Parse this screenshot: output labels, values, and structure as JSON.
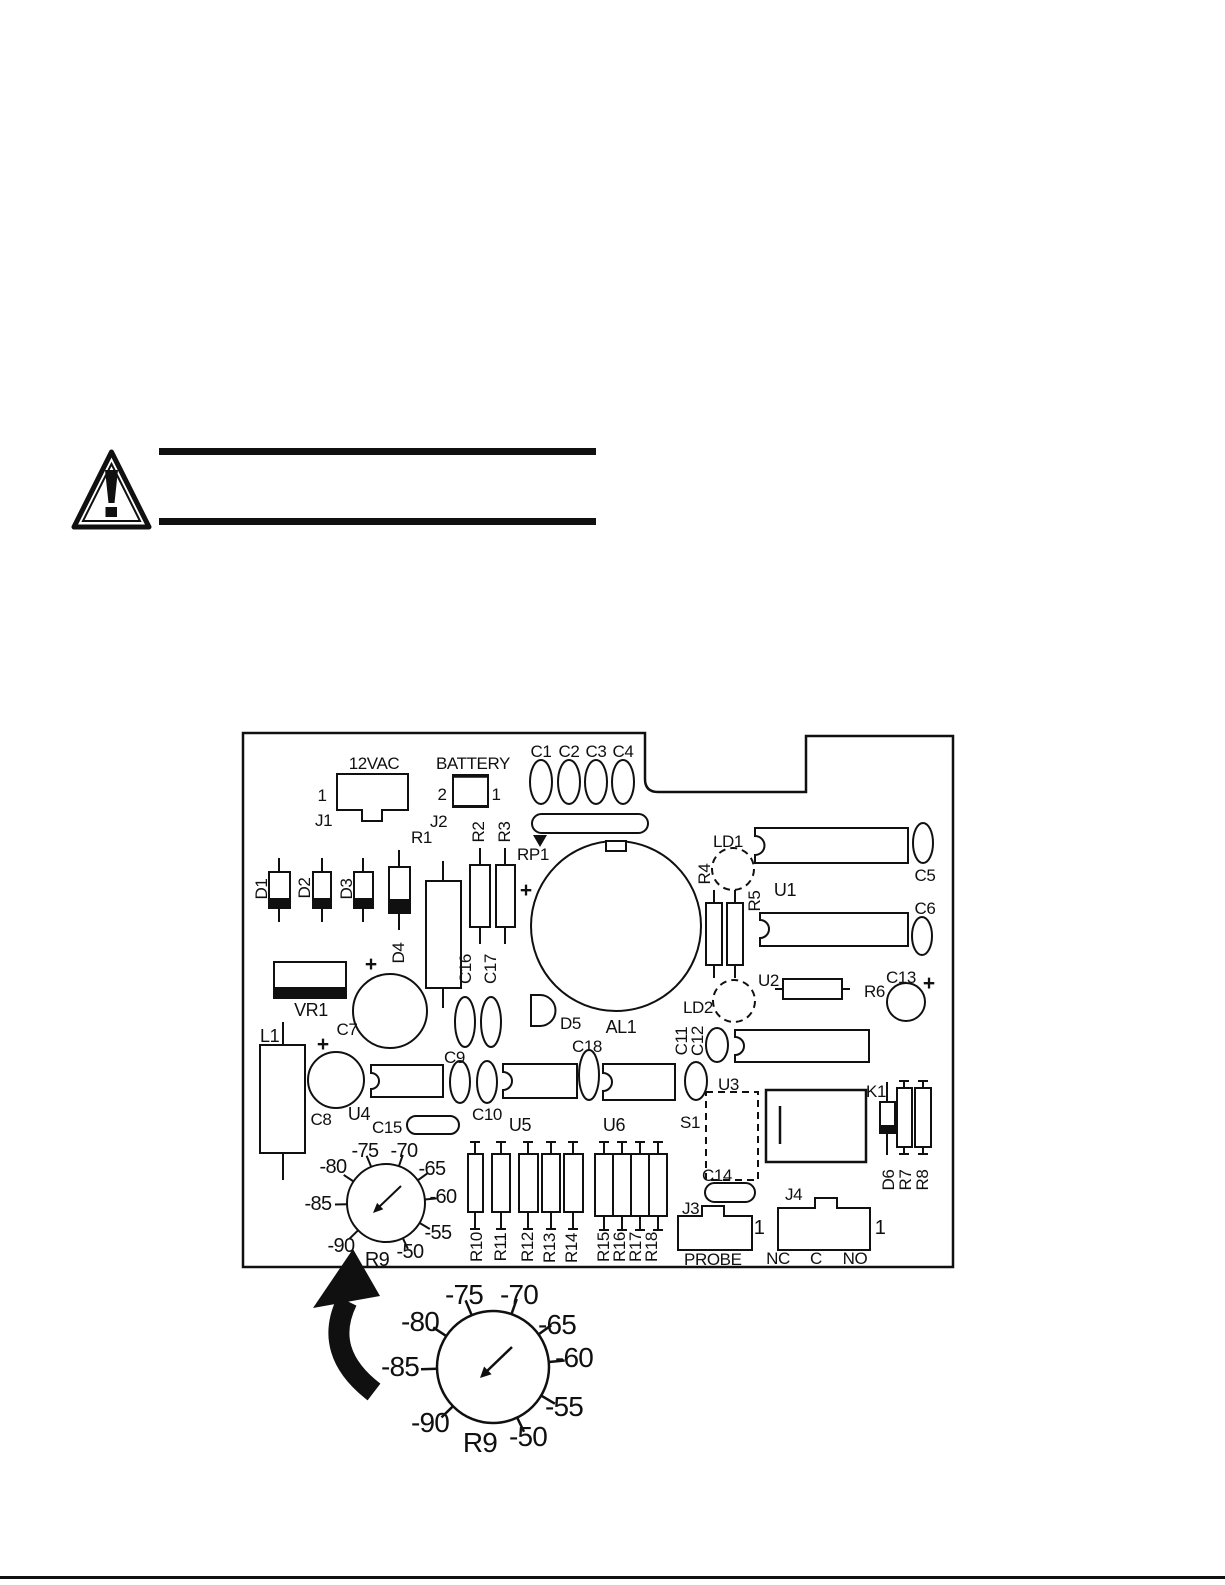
{
  "pcb": {
    "labels": {
      "plus": "+",
      "j1_title": "12VAC",
      "j1_name": "J1",
      "j1_pin1": "1",
      "j2_title": "BATTERY",
      "j2_name": "J2",
      "j2_pin1": "1",
      "j2_pin2": "2",
      "c1": "C1",
      "c2": "C2",
      "c3": "C3",
      "c4": "C4",
      "rp1": "RP1",
      "r1": "R1",
      "r2": "R2",
      "r3": "R3",
      "d1": "D1",
      "d2": "D2",
      "d3": "D3",
      "d4": "D4",
      "d5": "D5",
      "ld1": "LD1",
      "ld2": "LD2",
      "r4": "R4",
      "r5": "R5",
      "u1": "U1",
      "u2": "U2",
      "u3": "U3",
      "u4": "U4",
      "u5": "U5",
      "u6": "U6",
      "c5": "C5",
      "c6": "C6",
      "c13": "C13",
      "r6": "R6",
      "al1": "AL1",
      "vr1": "VR1",
      "c7": "C7",
      "c16": "C16",
      "c17": "C17",
      "l1": "L1",
      "c8": "C8",
      "c9": "C9",
      "c10": "C10",
      "c11": "C11",
      "c12": "C12",
      "c15": "C15",
      "c18": "C18",
      "s1": "S1",
      "k1": "K1",
      "c14": "C14",
      "d6": "D6",
      "r7": "R7",
      "r8": "R8",
      "r10": "R10",
      "r11": "R11",
      "r12": "R12",
      "r13": "R13",
      "r14": "R14",
      "r15": "R15",
      "r16": "R16",
      "r17": "R17",
      "r18": "R18",
      "j3_name": "J3",
      "j3_pin1": "1",
      "j3_title": "PROBE",
      "j4_name": "J4",
      "j4_pin1": "1",
      "j4_nc": "NC",
      "j4_c": "C",
      "j4_no": "NO"
    },
    "dial": {
      "name": "R9",
      "ticks": {
        "m75": "-75",
        "m70": "-70",
        "m80": "-80",
        "m65": "-65",
        "m85": "-85",
        "m60": "-60",
        "m90": "-90",
        "m55": "-55",
        "m50": "-50"
      }
    }
  }
}
